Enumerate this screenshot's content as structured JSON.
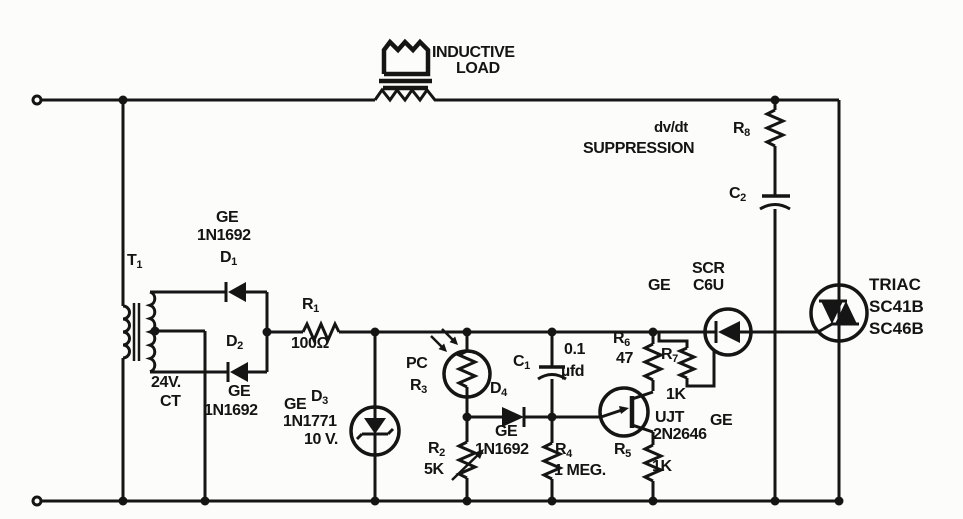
{
  "diagram": {
    "type": "schematic",
    "notes": {
      "load_l1": "INDUCTIVE",
      "load_l2": "LOAD",
      "snub_l1": "dv/dt",
      "snub_l2": "SUPPRESSION"
    },
    "components": {
      "t1": {
        "ref": "T",
        "sub": "1",
        "secondary": "24V.",
        "tap": "CT"
      },
      "d1": {
        "ref": "D",
        "sub": "1",
        "brand": "GE",
        "part": "1N1692"
      },
      "d2": {
        "ref": "D",
        "sub": "2",
        "brand": "GE",
        "part": "1N1692"
      },
      "d3": {
        "ref": "D",
        "sub": "3",
        "brand": "GE",
        "part": "1N1771",
        "value": "10 V."
      },
      "d4": {
        "ref": "D",
        "sub": "4",
        "brand": "GE",
        "part": "1N1692"
      },
      "r1": {
        "ref": "R",
        "sub": "1",
        "value": "100Ω"
      },
      "r2": {
        "ref": "R",
        "sub": "2",
        "value": "5K"
      },
      "r3": {
        "ref": "R",
        "sub": "3",
        "kind": "PC"
      },
      "r4": {
        "ref": "R",
        "sub": "4",
        "value": "1 MEG."
      },
      "r5": {
        "ref": "R",
        "sub": "5",
        "value": "1K"
      },
      "r6": {
        "ref": "R",
        "sub": "6",
        "value": "47"
      },
      "r7": {
        "ref": "R",
        "sub": "7",
        "value": "1K"
      },
      "r8": {
        "ref": "R",
        "sub": "8"
      },
      "c1": {
        "ref": "C",
        "sub": "1",
        "value": "0.1",
        "unit": "µfd"
      },
      "c2": {
        "ref": "C",
        "sub": "2"
      },
      "scr": {
        "kind": "SCR",
        "brand": "GE",
        "part": "C6U"
      },
      "ujt": {
        "kind": "UJT",
        "brand": "GE",
        "part": "2N2646"
      },
      "triac": {
        "kind": "TRIAC",
        "part_a": "SC41B",
        "part_b": "SC46B"
      }
    },
    "colors": {
      "ink": "#151515",
      "paper": "#fcfcfa"
    }
  }
}
